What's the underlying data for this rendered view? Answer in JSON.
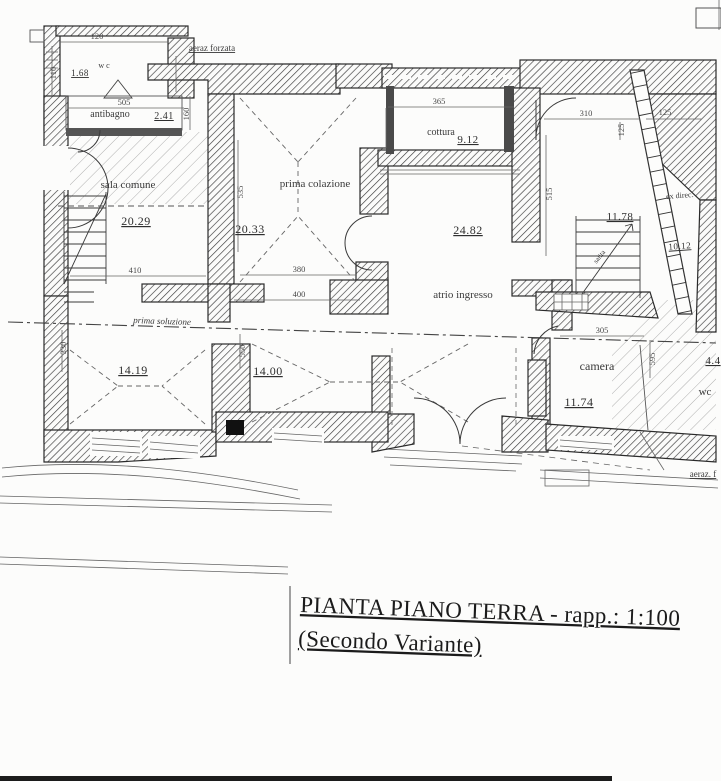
{
  "drawing": {
    "title_line1": "PIANTA PIANO TERRA - rapp.: 1:100",
    "title_line2": "(Secondo Variante)",
    "ink_color": "#2b2b2b",
    "paper_color": "#fcfcfb"
  },
  "rooms": [
    {
      "name": "wc-piccolo",
      "label": "w c",
      "area": "1.68",
      "label_x": 104,
      "label_y": 68,
      "label_size": 8,
      "area_x": 80,
      "area_y": 76,
      "area_size": 9
    },
    {
      "name": "antibagno",
      "label": "antibagno",
      "area": "2.41",
      "label_x": 110,
      "label_y": 117,
      "label_size": 10,
      "area_x": 164,
      "area_y": 119,
      "area_size": 10
    },
    {
      "name": "sala-comune",
      "label": "sala comune",
      "area": "20.29",
      "label_x": 128,
      "label_y": 188,
      "label_size": 11,
      "area_x": 136,
      "area_y": 225,
      "area_size": 12
    },
    {
      "name": "prima-colazione",
      "label": "prima colazione",
      "area": "20.33",
      "label_x": 315,
      "label_y": 187,
      "label_size": 11,
      "area_x": 250,
      "area_y": 233,
      "area_size": 12
    },
    {
      "name": "cottura",
      "label": "cottura",
      "area": "9.12",
      "label_x": 441,
      "label_y": 135,
      "label_size": 10,
      "area_x": 468,
      "area_y": 143,
      "area_size": 11
    },
    {
      "name": "atrio-ingresso",
      "label": "atrio ingresso",
      "area": "24.82",
      "label_x": 463,
      "label_y": 298,
      "label_size": 11,
      "area_x": 468,
      "area_y": 234,
      "area_size": 12
    },
    {
      "name": "vano-scala",
      "label": "",
      "area": "11.78",
      "label_x": 620,
      "label_y": 205,
      "label_size": 10,
      "area_x": 620,
      "area_y": 220,
      "area_size": 11
    },
    {
      "name": "vano-esterno",
      "label": "ex direc.",
      "area": "10.12",
      "label_x": 680,
      "label_y": 198,
      "label_size": 8,
      "area_x": 680,
      "area_y": 249,
      "area_size": 9,
      "rot": -4
    },
    {
      "name": "stanza-14-19",
      "label": "",
      "area": "14.19",
      "label_x": 133,
      "label_y": 360,
      "label_size": 10,
      "area_x": 133,
      "area_y": 374,
      "area_size": 12
    },
    {
      "name": "stanza-14-00",
      "label": "",
      "area": "14.00",
      "label_x": 268,
      "label_y": 360,
      "label_size": 10,
      "area_x": 268,
      "area_y": 375,
      "area_size": 12
    },
    {
      "name": "camera",
      "label": "camera",
      "area": "11.74",
      "label_x": 597,
      "label_y": 370,
      "label_size": 12,
      "area_x": 579,
      "area_y": 406,
      "area_size": 12
    },
    {
      "name": "wc-camera",
      "label": "wc",
      "area": "4.4",
      "label_x": 705,
      "label_y": 395,
      "label_size": 11,
      "area_x": 713,
      "area_y": 364,
      "area_size": 11
    }
  ],
  "dimensions": [
    {
      "value": "120",
      "x": 97,
      "y": 39
    },
    {
      "value": "110",
      "x": 56,
      "y": 73,
      "rot": -90
    },
    {
      "value": "505",
      "x": 124,
      "y": 105
    },
    {
      "value": "160",
      "x": 189,
      "y": 114,
      "rot": -90
    },
    {
      "value": "365",
      "x": 439,
      "y": 104
    },
    {
      "value": "215",
      "x": 392,
      "y": 128,
      "rot": -90
    },
    {
      "value": "310",
      "x": 586,
      "y": 116
    },
    {
      "value": "125",
      "x": 665,
      "y": 115
    },
    {
      "value": "125",
      "x": 624,
      "y": 130,
      "rot": -90
    },
    {
      "value": "515",
      "x": 552,
      "y": 194,
      "rot": -90
    },
    {
      "value": "535",
      "x": 243,
      "y": 192,
      "rot": -90
    },
    {
      "value": "410",
      "x": 135,
      "y": 273
    },
    {
      "value": "380",
      "x": 299,
      "y": 272
    },
    {
      "value": "400",
      "x": 299,
      "y": 297
    },
    {
      "value": "330",
      "x": 66,
      "y": 348,
      "rot": -90
    },
    {
      "value": "550",
      "x": 245,
      "y": 351,
      "rot": -90
    },
    {
      "value": "305",
      "x": 602,
      "y": 333
    },
    {
      "value": "595",
      "x": 655,
      "y": 359,
      "rot": -90
    }
  ],
  "annotations": [
    {
      "name": "aeraz-forzata-top",
      "text": "aeraz forzata",
      "x": 212,
      "y": 51,
      "size": 9,
      "underline": true
    },
    {
      "name": "aeraz-forzata-bottom",
      "text": "aeraz. f",
      "x": 703,
      "y": 477,
      "size": 9,
      "underline": true
    },
    {
      "name": "linea-prima-soluzione",
      "text": "prima soluzione",
      "x": 162,
      "y": 324,
      "size": 9,
      "italic": true,
      "rot": 2
    },
    {
      "name": "salita-scala",
      "text": "salita",
      "x": 601,
      "y": 258,
      "size": 7,
      "rot": -52
    }
  ]
}
